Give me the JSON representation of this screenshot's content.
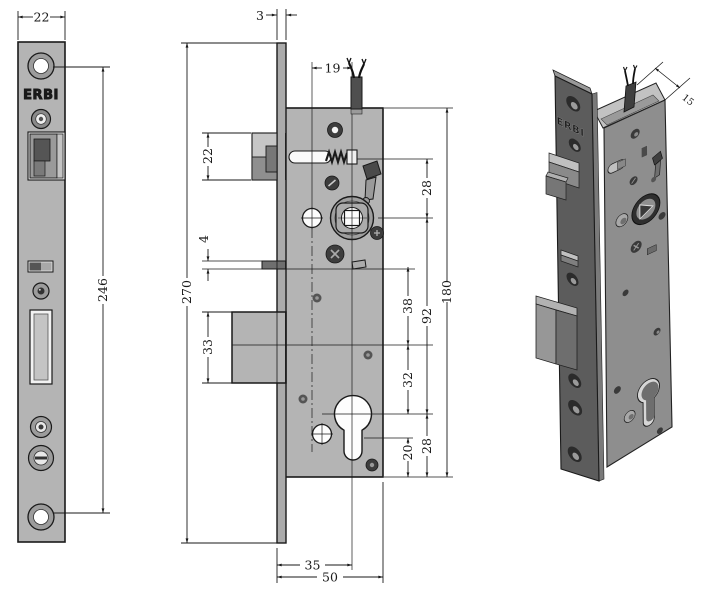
{
  "title": "ERBI mortise lock technical drawing",
  "brand": {
    "front_label": "ERBI",
    "iso_label": "ERBI"
  },
  "dims": {
    "plate_width": "22",
    "hole_spacing": "246",
    "plate_thickness": "3",
    "cable_offset": "19",
    "latch_height": "22",
    "pin_height": "4",
    "plate_length": "270",
    "deadbolt_height": "33",
    "slot_to_hub": "28",
    "body_height": "180",
    "hub_to_cylinder": "92",
    "pin_to_deadbolt": "38",
    "deadbolt_to_cylinder": "32",
    "slot_bottom_margin": "20",
    "cylinder_to_bottom": "28",
    "backset": "35",
    "body_depth": "50",
    "case_thickness": "15"
  },
  "colors": {
    "line": "#1a1a1a",
    "body_gray": "#b4b4b4",
    "dark_fill": "#3d3d3d",
    "iso_plate": "#5c5c5c",
    "iso_case": "#8e8e8e",
    "iso_top": "#c4c4c4"
  }
}
